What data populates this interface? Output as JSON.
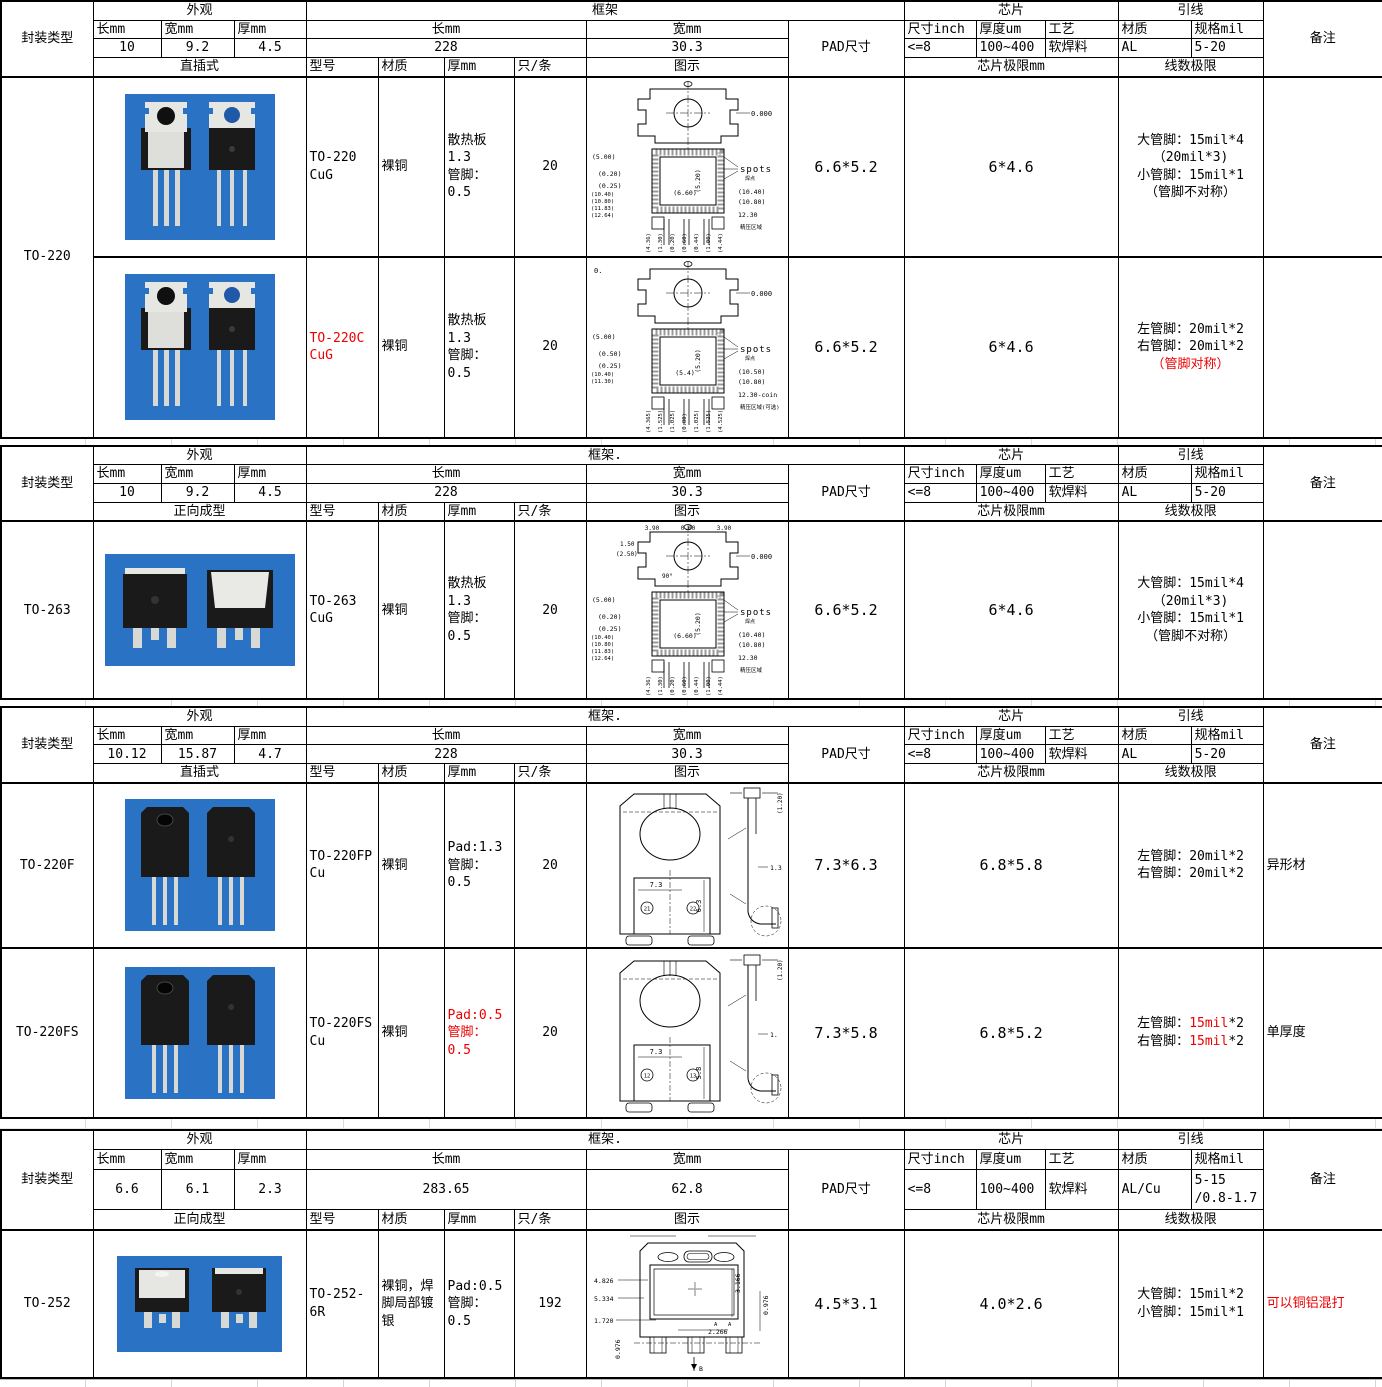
{
  "palette": {
    "red": "#ee0000",
    "photo_bg": "#2a72c4",
    "silver": "#e6e6e2",
    "body_black": "#1a1a1a"
  },
  "sections": [
    {
      "package_type": "TO-220",
      "header": {
        "package_type_label": "封装类型",
        "appearance_title": "外观",
        "len_label": "长mm",
        "wid_label": "宽mm",
        "thk_label": "厚mm",
        "appearance_values": [
          "10",
          "9.2",
          "4.5"
        ],
        "frame_title": "框架",
        "frame_len_label": "长mm",
        "frame_len": "228",
        "frame_wid_label": "宽mm",
        "frame_wid": "30.3",
        "pad_label": "PAD尺寸",
        "chip_title": "芯片",
        "chip_cols": [
          "尺寸inch",
          "厚度um",
          "工艺"
        ],
        "chip_values": [
          "<=8",
          "100~400",
          "软焊料"
        ],
        "lead_title": "引线",
        "lead_cols": [
          "材质",
          "规格mil"
        ],
        "lead_values": [
          "AL",
          "5-20"
        ],
        "remark_label": "备注",
        "mount_label": "直插式",
        "col_labels": [
          "型号",
          "材质",
          "厚mm",
          "只/条",
          "图示"
        ],
        "chip_limit_label": "芯片极限mm",
        "wire_limit_label": "线数极限"
      },
      "side": [
        {
          "label": "TO-220",
          "span": 2
        }
      ],
      "rows": [
        {
          "model": "TO-220 CuG",
          "model_red": false,
          "material": "裸铜",
          "thickness": "散热板\n1.3\n管脚：\n0.5",
          "thickness_red": false,
          "qty": "20",
          "pad_size": "6.6*5.2",
          "chip_limit": "6*4.6",
          "wire_limit": [
            [
              {
                "t": "大管脚：15mil*4"
              }
            ],
            [
              {
                "t": "（20mil*3)"
              }
            ],
            [
              {
                "t": "小管脚：15mil*1"
              }
            ],
            [
              {
                "t": "（管脚不对称）"
              }
            ]
          ],
          "remark": "",
          "remark_red": false,
          "photo": "to220",
          "diagram": "to220a"
        },
        {
          "model": "TO-220C CuG",
          "model_red": true,
          "material": "裸铜",
          "thickness": "散热板\n1.3\n管脚：\n0.5",
          "thickness_red": false,
          "qty": "20",
          "pad_size": "6.6*5.2",
          "chip_limit": "6*4.6",
          "wire_limit": [
            [
              {
                "t": "左管脚：20mil*2"
              }
            ],
            [
              {
                "t": "右管脚：20mil*2"
              }
            ],
            [
              {
                "t": "（管脚对称）",
                "red": true
              }
            ]
          ],
          "remark": "",
          "remark_red": false,
          "photo": "to220",
          "diagram": "to220b"
        }
      ]
    },
    {
      "package_type": "TO-263",
      "header": {
        "package_type_label": "封装类型",
        "appearance_title": "外观",
        "len_label": "长mm",
        "wid_label": "宽mm",
        "thk_label": "厚mm",
        "appearance_values": [
          "10",
          "9.2",
          "4.5"
        ],
        "frame_title": "框架.",
        "frame_len_label": "长mm",
        "frame_len": "228",
        "frame_wid_label": "宽mm",
        "frame_wid": "30.3",
        "pad_label": "PAD尺寸",
        "chip_title": "芯片",
        "chip_cols": [
          "尺寸inch",
          "厚度um",
          "工艺"
        ],
        "chip_values": [
          "<=8",
          "100~400",
          "软焊料"
        ],
        "lead_title": "引线",
        "lead_cols": [
          "材质",
          "规格mil"
        ],
        "lead_values": [
          "AL",
          "5-20"
        ],
        "remark_label": "备注",
        "mount_label": "正向成型",
        "col_labels": [
          "型号",
          "材质",
          "厚mm",
          "只/条",
          "图示"
        ],
        "chip_limit_label": "芯片极限mm",
        "wire_limit_label": "线数极限"
      },
      "side": [
        {
          "label": "TO-263",
          "span": 1
        }
      ],
      "rows": [
        {
          "model": "TO-263 CuG",
          "model_red": false,
          "material": "裸铜",
          "thickness": "散热板\n1.3\n管脚：\n0.5",
          "thickness_red": false,
          "qty": "20",
          "pad_size": "6.6*5.2",
          "chip_limit": "6*4.6",
          "wire_limit": [
            [
              {
                "t": "大管脚：15mil*4"
              }
            ],
            [
              {
                "t": "（20mil*3)"
              }
            ],
            [
              {
                "t": "小管脚：15mil*1"
              }
            ],
            [
              {
                "t": "（管脚不对称）"
              }
            ]
          ],
          "remark": "",
          "remark_red": false,
          "photo": "to263",
          "diagram": "to263"
        }
      ]
    },
    {
      "package_type": "TO-220F",
      "header": {
        "package_type_label": "封装类型",
        "appearance_title": "外观",
        "len_label": "长mm",
        "wid_label": "宽mm",
        "thk_label": "厚mm",
        "appearance_values": [
          "10.12",
          "15.87",
          "4.7"
        ],
        "frame_title": "框架.",
        "frame_len_label": "长mm",
        "frame_len": "228",
        "frame_wid_label": "宽mm",
        "frame_wid": "30.3",
        "pad_label": "PAD尺寸",
        "chip_title": "芯片",
        "chip_cols": [
          "尺寸inch",
          "厚度um",
          "工艺"
        ],
        "chip_values": [
          "<=8",
          "100~400",
          "软焊料"
        ],
        "lead_title": "引线",
        "lead_cols": [
          "材质",
          "规格mil"
        ],
        "lead_values": [
          "AL",
          "5-20"
        ],
        "remark_label": "备注",
        "mount_label": "直插式",
        "col_labels": [
          "型号",
          "材质",
          "厚mm",
          "只/条",
          "图示"
        ],
        "chip_limit_label": "芯片极限mm",
        "wire_limit_label": "线数极限"
      },
      "side": [
        {
          "label": "TO-220F",
          "span": 1
        },
        {
          "label": "TO-220FS",
          "span": 1
        }
      ],
      "rows": [
        {
          "model": "TO-220FP Cu",
          "model_red": false,
          "material": "裸铜",
          "thickness": "Pad:1.3\n管脚：\n0.5",
          "thickness_red": false,
          "qty": "20",
          "pad_size": "7.3*6.3",
          "chip_limit": "6.8*5.8",
          "wire_limit": [
            [
              {
                "t": "左管脚：20mil*2"
              }
            ],
            [
              {
                "t": "右管脚：20mil*2"
              }
            ]
          ],
          "remark": "异形材",
          "remark_red": false,
          "photo": "to220f",
          "diagram": "to220f"
        },
        {
          "model": "TO-220FS Cu",
          "model_red": false,
          "material": "裸铜",
          "thickness": "Pad:0.5\n管脚：\n0.5",
          "thickness_red": true,
          "qty": "20",
          "pad_size": "7.3*5.8",
          "chip_limit": "6.8*5.2",
          "wire_limit": [
            [
              {
                "t": "左管脚："
              },
              {
                "t": "15mil",
                "red": true
              },
              {
                "t": "*2"
              }
            ],
            [
              {
                "t": "右管脚："
              },
              {
                "t": "15mil",
                "red": true
              },
              {
                "t": "*2"
              }
            ]
          ],
          "remark": "单厚度",
          "remark_red": false,
          "photo": "to220f",
          "diagram": "to220fs"
        }
      ]
    },
    {
      "package_type": "TO-252",
      "header": {
        "package_type_label": "封装类型",
        "appearance_title": "外观",
        "len_label": "长mm",
        "wid_label": "宽mm",
        "thk_label": "厚mm",
        "appearance_values": [
          "6.6",
          "6.1",
          "2.3"
        ],
        "frame_title": "框架.",
        "frame_len_label": "长mm",
        "frame_len": "283.65",
        "frame_wid_label": "宽mm",
        "frame_wid": "62.8",
        "pad_label": "PAD尺寸",
        "chip_title": "芯片",
        "chip_cols": [
          "尺寸inch",
          "厚度um",
          "工艺"
        ],
        "chip_values": [
          "<=8",
          "100~400",
          "软焊料"
        ],
        "lead_title": "引线",
        "lead_cols": [
          "材质",
          "规格mil"
        ],
        "lead_values": [
          "AL/Cu",
          "5-15\n/0.8-1.7"
        ],
        "remark_label": "备注",
        "mount_label": "正向成型",
        "col_labels": [
          "型号",
          "材质",
          "厚mm",
          "只/条",
          "图示"
        ],
        "chip_limit_label": "芯片极限mm",
        "wire_limit_label": "线数极限"
      },
      "side": [
        {
          "label": "TO-252",
          "span": 1
        }
      ],
      "rows": [
        {
          "model": "TO-252-6R",
          "model_red": false,
          "material": "裸铜，焊脚局部镀银",
          "thickness": "Pad:0.5\n管脚：\n0.5",
          "thickness_red": false,
          "qty": "192",
          "pad_size": "4.5*3.1",
          "chip_limit": "4.0*2.6",
          "wire_limit": [
            [
              {
                "t": "大管脚：15mil*2"
              }
            ],
            [
              {
                "t": "小管脚：15mil*1"
              }
            ]
          ],
          "remark": "可以铜铝混打",
          "remark_red": true,
          "photo": "to252",
          "diagram": "to252"
        }
      ]
    }
  ],
  "diagrams": {
    "to220a": {
      "kind": "to220",
      "topleft": "",
      "top": [],
      "left2": [],
      "left": [
        "(5.00)",
        "(0.20)",
        "(0.25)"
      ],
      "mid": "(6.60)",
      "vert": "(5.20)",
      "spots": "spots",
      "spots_sub": "焊点",
      "right": [
        "0.000",
        "(10.40)",
        "(10.80)",
        "12.30"
      ],
      "stack": [
        "(10.40)",
        "(10.80)",
        "(11.83)",
        "(12.64)"
      ],
      "bottom": [
        "(4.36)",
        "(1.30)",
        "(0.20)",
        "(0.60)",
        "(0.44)",
        "(1.00)",
        "(4.44)"
      ],
      "note": "精压区域"
    },
    "to220b": {
      "kind": "to220",
      "topleft": "0.",
      "top": [],
      "left2": [],
      "left": [
        "(5.00)",
        "(0.50)",
        "(0.25)"
      ],
      "mid": "(5.4)",
      "vert": "(5.20)",
      "spots": "spots",
      "spots_sub": "焊点",
      "right": [
        "0.000",
        "(10.50)",
        "(10.80)",
        "12.30-coin"
      ],
      "stack": [
        "(10.40)",
        "(11.30)"
      ],
      "bottom": [
        "(4.365)",
        "(1.525)",
        "(1.025)",
        "(0.80)",
        "(1.025)",
        "(1.525)",
        "(4.525)"
      ],
      "note": "精压区域(可选)"
    },
    "to263": {
      "kind": "to220",
      "topleft": "",
      "top": [
        "3.90",
        "0.00",
        "3.90"
      ],
      "left2": [
        "1.50",
        "(2.50)",
        "90°"
      ],
      "left": [
        "(5.00)",
        "(0.20)",
        "(0.25)"
      ],
      "mid": "(6.60)",
      "vert": "(5.20)",
      "spots": "spots",
      "spots_sub": "焊点",
      "right": [
        "0.000",
        "(10.40)",
        "(10.80)",
        "12.30"
      ],
      "stack": [
        "(10.40)",
        "(10.80)",
        "(11.83)",
        "(12.64)"
      ],
      "bottom": [
        "(4.36)",
        "(1.30)",
        "(0.20)",
        "(0.60)",
        "(0.44)",
        "(1.00)",
        "(4.44)"
      ],
      "note": "精压区域"
    },
    "to220f": {
      "kind": "to220f",
      "width_dim": "7.3",
      "height_dim": "6.3",
      "circles": [
        "21",
        "22"
      ],
      "side": [
        "(1.20)",
        "1.3"
      ]
    },
    "to220fs": {
      "kind": "to220f",
      "width_dim": "7.3",
      "height_dim": "5.8",
      "circles": [
        "12",
        "13"
      ],
      "side": [
        "(1.20)",
        "1."
      ]
    },
    "to252": {
      "kind": "to252",
      "left": [
        "4.826",
        "5.334",
        "1.720"
      ],
      "right_rot": [
        "3.166",
        "0.976"
      ],
      "dim_2266": "2.266",
      "bottom_rot": "0.976",
      "marks": [
        "A",
        "A"
      ],
      "arrow": "B"
    }
  }
}
